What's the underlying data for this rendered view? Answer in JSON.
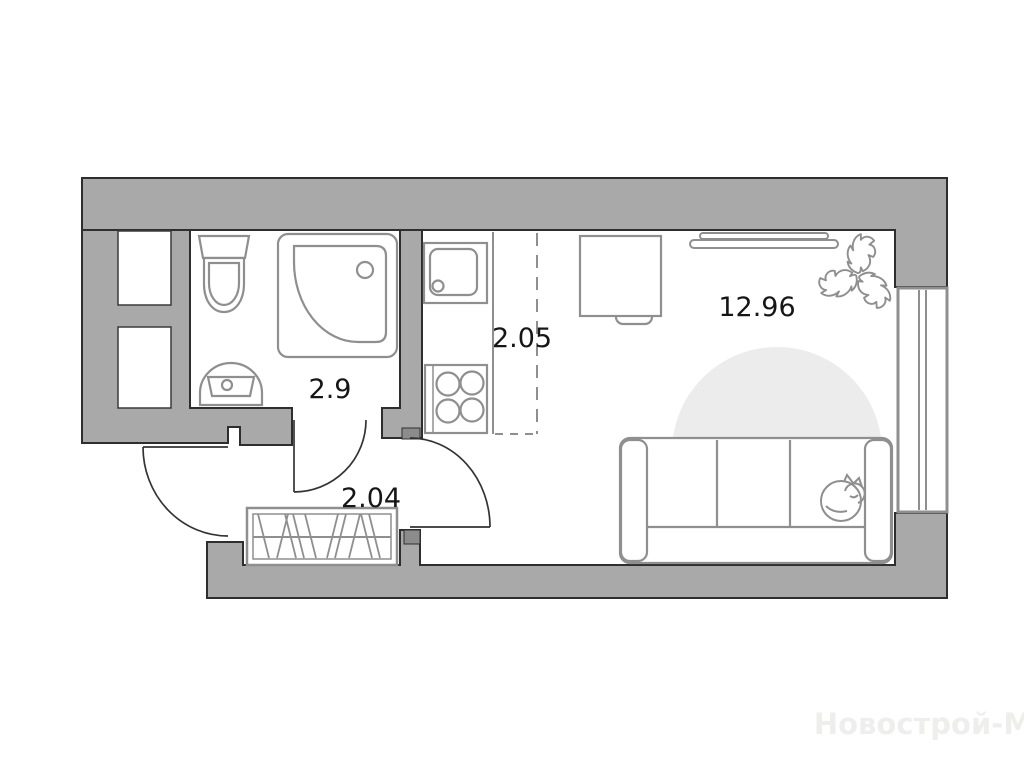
{
  "plan": {
    "title_watermark": "Новострой-М",
    "rooms": {
      "bathroom": {
        "area_label": "2.9"
      },
      "kitchen": {
        "area_label": "2.05"
      },
      "living_room": {
        "area_label": "12.96"
      },
      "hallway": {
        "area_label": "2.04"
      }
    },
    "fixtures": [
      "toilet-icon",
      "corner-shower-icon",
      "washbasin-icon",
      "vent-shaft",
      "vent-shaft",
      "kitchen-sink-icon",
      "stove-icon",
      "kitchen-zone-dashed-line",
      "counter-edge",
      "desk-icon",
      "chair-icon",
      "tv-icon",
      "monstera-plant-icon",
      "rug-icon",
      "sofa-icon",
      "sleeping-cat-icon",
      "window-icon",
      "entrance-door-icon",
      "room-door-icon",
      "bathroom-door-icon",
      "wardrobe-icon"
    ],
    "colors": {
      "wall_fill": "#a9a9a9",
      "wall_stroke": "#2e2e2e",
      "jamb_fill": "#8c8c8c",
      "furniture_stroke": "#8f8f8f",
      "door_stroke": "#333333",
      "rug_fill": "#ececec",
      "label_color": "#161616",
      "watermark_color": "#eeeeec",
      "background": "#ffffff"
    }
  }
}
